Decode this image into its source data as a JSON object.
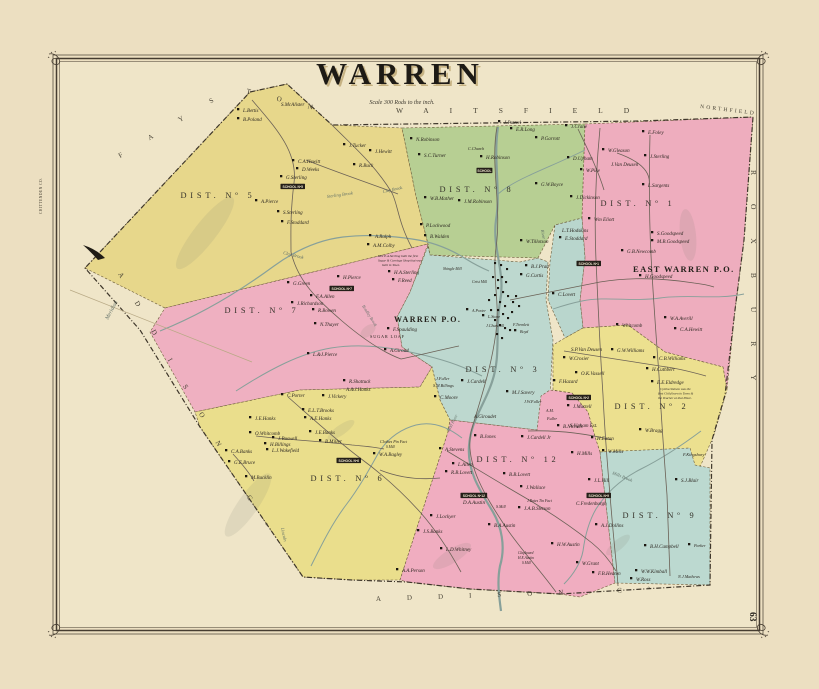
{
  "map": {
    "title": "WARREN",
    "scale_note": "Scale 300 Rods to the inch.",
    "page_number": "63",
    "post_offices": {
      "warren": "WARREN P.O.",
      "east_warren": "EAST WARREN P.O."
    },
    "neighbors": {
      "waitsfield": "WAITSFIELD",
      "northfield": "NORTHFIELD",
      "fayston_a": "FAYS",
      "fayston_b": "TON",
      "roxbury": "ROXBURY",
      "addison_side": "ADDISON Cº",
      "addison_bottom": "ADDISON Cº",
      "chittenden": "CHITTENDEN CO.",
      "meridian": "Meridian"
    },
    "colors": {
      "parchment": "#ecdfc1",
      "map_ground": "#efe5c8",
      "ink": "#2b2620",
      "water": "#87a09a",
      "road": "#6b6156",
      "frame": "#453c30",
      "dot": "#1b1711"
    },
    "districts": [
      {
        "id": "district-5",
        "label": "DIST. Nº 5",
        "color": "#e7d78b"
      },
      {
        "id": "district-7",
        "label": "DIST. Nº 7",
        "color": "#efb0c1"
      },
      {
        "id": "district-8",
        "label": "DIST. Nº 8",
        "color": "#b7cf93"
      },
      {
        "id": "district-1-east-warren",
        "label": "DIST. Nº 1",
        "color": "#eeadbe"
      },
      {
        "id": "district-3-east-sliver",
        "label": "",
        "color": "#b9d6cd"
      },
      {
        "id": "district-3",
        "label": "DIST. Nº 3",
        "color": "#bdd8cf"
      },
      {
        "id": "district-6",
        "label": "DIST. Nº 6",
        "color": "#eade8c"
      },
      {
        "id": "district-12",
        "label": "DIST. Nº 12",
        "color": "#f0adc0"
      },
      {
        "id": "district-2",
        "label": "DIST. Nº 2",
        "color": "#ece08f"
      },
      {
        "id": "district-9",
        "label": "DIST. Nº 9",
        "color": "#bcd9d0"
      }
    ],
    "labels": [
      {
        "t": "L.Bettis",
        "x": 243,
        "y": 112,
        "d": 1
      },
      {
        "t": "B.Poland",
        "x": 243,
        "y": 121,
        "d": 1
      },
      {
        "t": "S.McAlister",
        "x": 281,
        "y": 106
      },
      {
        "t": "J.Tucker",
        "x": 349,
        "y": 147,
        "d": 1
      },
      {
        "t": "C.A.Hewitt",
        "x": 298,
        "y": 163,
        "d": 1
      },
      {
        "t": "D.Weeks",
        "x": 302,
        "y": 171,
        "d": 1
      },
      {
        "t": "G.Sterling",
        "x": 286,
        "y": 179,
        "d": 1
      },
      {
        "t": "SCHOOL Nº5",
        "x": 282,
        "y": 188,
        "c": "school"
      },
      {
        "t": "A.Pierce",
        "x": 261,
        "y": 203,
        "d": 1
      },
      {
        "t": "S.Sterling",
        "x": 283,
        "y": 214,
        "d": 1
      },
      {
        "t": "F.Stoddard",
        "x": 287,
        "y": 224,
        "d": 1
      },
      {
        "t": "R.Buck",
        "x": 359,
        "y": 167,
        "d": 1
      },
      {
        "t": "J.Hewitt",
        "x": 375,
        "y": 153,
        "d": 1
      },
      {
        "t": "A.Ralph",
        "x": 375,
        "y": 238,
        "d": 1
      },
      {
        "t": "A.M.Colby",
        "x": 373,
        "y": 247,
        "d": 1
      },
      {
        "t": "Sterling Brook",
        "x": 327,
        "y": 198,
        "c": "water",
        "s": 4.5,
        "r": -8
      },
      {
        "t": "Clay Brook",
        "x": 283,
        "y": 254,
        "c": "water",
        "s": 4.6,
        "r": 14
      },
      {
        "t": "Clay Brook",
        "x": 383,
        "y": 193,
        "c": "water",
        "s": 4.4,
        "r": -12
      },
      {
        "t": "N.Robinson",
        "x": 416,
        "y": 141,
        "d": 1
      },
      {
        "t": "S.C.Turner",
        "x": 424,
        "y": 157,
        "d": 1
      },
      {
        "t": "C.Church",
        "x": 468,
        "y": 150,
        "s": 4.2
      },
      {
        "t": "H.Robinson",
        "x": 486,
        "y": 159,
        "d": 1
      },
      {
        "t": "SCHOOL",
        "x": 478,
        "y": 172,
        "c": "school"
      },
      {
        "t": "J.Puttrel",
        "x": 504,
        "y": 124,
        "d": 1
      },
      {
        "t": "E.R.Long",
        "x": 516,
        "y": 131,
        "d": 1
      },
      {
        "t": "P.Garrott",
        "x": 541,
        "y": 140,
        "d": 1
      },
      {
        "t": "W.B.Mather",
        "x": 430,
        "y": 200,
        "d": 1
      },
      {
        "t": "J.M.Robinson",
        "x": 464,
        "y": 203,
        "d": 1
      },
      {
        "t": "P.Lockwood",
        "x": 426,
        "y": 227,
        "d": 1
      },
      {
        "t": "B.Walden",
        "x": 430,
        "y": 238,
        "d": 1
      },
      {
        "t": "G.W.Boyce",
        "x": 541,
        "y": 186,
        "d": 1
      },
      {
        "t": "River",
        "x": 541,
        "y": 230,
        "c": "water",
        "s": 4.4,
        "r": 80
      },
      {
        "t": "J.Crane",
        "x": 571,
        "y": 128,
        "d": 1
      },
      {
        "t": "E.Foley",
        "x": 648,
        "y": 134,
        "d": 1
      },
      {
        "t": "W.Gleason",
        "x": 608,
        "y": 152,
        "d": 1
      },
      {
        "t": "D.Upham",
        "x": 573,
        "y": 160,
        "d": 1
      },
      {
        "t": "J.Sterling",
        "x": 650,
        "y": 158,
        "d": 1
      },
      {
        "t": "J.Van Deusen",
        "x": 611,
        "y": 166
      },
      {
        "t": "W.Pike",
        "x": 586,
        "y": 172,
        "d": 1
      },
      {
        "t": "L.Sargents",
        "x": 648,
        "y": 187,
        "d": 1
      },
      {
        "t": "J.Dickinson",
        "x": 576,
        "y": 199,
        "d": 1
      },
      {
        "t": "Wm Eliott",
        "x": 594,
        "y": 221,
        "d": 1
      },
      {
        "t": "W.Tillotson",
        "x": 526,
        "y": 243,
        "d": 1
      },
      {
        "t": "B.J.Pratt",
        "x": 531,
        "y": 268,
        "d": 1
      },
      {
        "t": "G.Curtis",
        "x": 526,
        "y": 277,
        "d": 1
      },
      {
        "t": "L.T.Hodskins",
        "x": 562,
        "y": 232
      },
      {
        "t": "E.Stoddard",
        "x": 565,
        "y": 240,
        "d": 1
      },
      {
        "t": "S.Goodspeed",
        "x": 657,
        "y": 235,
        "d": 1
      },
      {
        "t": "M.B.Goodspeed",
        "x": 657,
        "y": 243,
        "d": 1
      },
      {
        "t": "G.B.Newcomb",
        "x": 627,
        "y": 253,
        "d": 1
      },
      {
        "t": "SCHOOL Nº1",
        "x": 578,
        "y": 265,
        "c": "school"
      },
      {
        "t": "H.Goodspeed",
        "x": 645,
        "y": 278,
        "d": 1
      },
      {
        "t": "W.A.Averill",
        "x": 670,
        "y": 320,
        "d": 1
      },
      {
        "t": "C.A.Hewitt",
        "x": 680,
        "y": 331,
        "d": 1
      },
      {
        "t": "C.Lovett",
        "x": 558,
        "y": 296,
        "d": 1
      },
      {
        "t": "Whitcomb",
        "x": 622,
        "y": 327,
        "d": 1
      },
      {
        "t": "S.P.Van Deusen",
        "x": 571,
        "y": 351
      },
      {
        "t": "W.Crosier",
        "x": 569,
        "y": 360,
        "d": 1
      },
      {
        "t": "G.W.Williams",
        "x": 617,
        "y": 352,
        "d": 1
      },
      {
        "t": "C.B.Williams",
        "x": 659,
        "y": 360,
        "d": 1
      },
      {
        "t": "H.Cuthbert",
        "x": 652,
        "y": 371,
        "d": 1
      },
      {
        "t": "O.K.Vassell",
        "x": 581,
        "y": 375,
        "d": 1
      },
      {
        "t": "F.Hazard",
        "x": 559,
        "y": 383,
        "d": 1
      },
      {
        "t": "E.E.Eldredge",
        "x": 657,
        "y": 384,
        "d": 1
      },
      {
        "t": "Cyntha Stetson was the",
        "x": 660,
        "y": 390,
        "c": "note"
      },
      {
        "t": "first Child born in Town &",
        "x": 658,
        "y": 394.5,
        "c": "note"
      },
      {
        "t": "the Teacher at that Place.",
        "x": 658,
        "y": 399,
        "c": "note"
      },
      {
        "t": "SCHOOL Nº2",
        "x": 568,
        "y": 399,
        "c": "school"
      },
      {
        "t": "J.Martell",
        "x": 573,
        "y": 408,
        "d": 1
      },
      {
        "t": "S.Upham Est.",
        "x": 570,
        "y": 427
      },
      {
        "t": "H.Eaton",
        "x": 597,
        "y": 440,
        "d": 1
      },
      {
        "t": "W.Bragg",
        "x": 645,
        "y": 432,
        "d": 1
      },
      {
        "t": "F.Kingsbury",
        "x": 683,
        "y": 456,
        "s": 4.4
      },
      {
        "t": "H.Mills",
        "x": 577,
        "y": 455,
        "d": 1
      },
      {
        "t": "W.Mills",
        "x": 608,
        "y": 453,
        "d": 1
      },
      {
        "t": "Mills Brook",
        "x": 612,
        "y": 474,
        "c": "water",
        "s": 4.5,
        "r": 22
      },
      {
        "t": "J.L.Hill",
        "x": 594,
        "y": 482,
        "d": 1
      },
      {
        "t": "SCHOOL Nº9",
        "x": 588,
        "y": 497,
        "c": "school"
      },
      {
        "t": "C.Fredenburgh",
        "x": 576,
        "y": 505
      },
      {
        "t": "S.J.Blair",
        "x": 681,
        "y": 482,
        "d": 1
      },
      {
        "t": "A.J.Dollins",
        "x": 601,
        "y": 527,
        "d": 1
      },
      {
        "t": "B.H.Campbell",
        "x": 650,
        "y": 548,
        "d": 1
      },
      {
        "t": "Parker",
        "x": 694,
        "y": 547,
        "s": 4.2,
        "d": 1
      },
      {
        "t": "N.J.Mathews",
        "x": 678,
        "y": 578,
        "s": 4.2
      },
      {
        "t": "W.W.Kimball",
        "x": 641,
        "y": 573,
        "d": 1
      },
      {
        "t": "W.Ross",
        "x": 636,
        "y": 581,
        "d": 1
      },
      {
        "t": "W.Grant",
        "x": 582,
        "y": 565,
        "d": 1
      },
      {
        "t": "F.B.Heaton",
        "x": 598,
        "y": 575,
        "d": 1
      },
      {
        "t": "B.Jones",
        "x": 480,
        "y": 438,
        "d": 1
      },
      {
        "t": "J.Cardell Jr",
        "x": 527,
        "y": 439,
        "d": 1
      },
      {
        "t": "A.Stevens",
        "x": 445,
        "y": 451,
        "d": 1
      },
      {
        "t": "L.Allen",
        "x": 458,
        "y": 466,
        "d": 1
      },
      {
        "t": "R.B.Lovett",
        "x": 451,
        "y": 474,
        "d": 1
      },
      {
        "t": "B.B.Lovett",
        "x": 509,
        "y": 476,
        "d": 1
      },
      {
        "t": "J.Wallace",
        "x": 526,
        "y": 489,
        "d": 1
      },
      {
        "t": "SCHOOL Nº12",
        "x": 462,
        "y": 497,
        "c": "school"
      },
      {
        "t": "D.A.Austin",
        "x": 463,
        "y": 504
      },
      {
        "t": "S.Mill",
        "x": 496,
        "y": 508,
        "s": 4
      },
      {
        "t": "J.Bates Tin Fact",
        "x": 527,
        "y": 502,
        "s": 3.8
      },
      {
        "t": "J.A.B.Stetson",
        "x": 524,
        "y": 510,
        "d": 1
      },
      {
        "t": "J.Lockyer",
        "x": 436,
        "y": 518,
        "d": 1
      },
      {
        "t": "J.S.Banks",
        "x": 423,
        "y": 533,
        "d": 1
      },
      {
        "t": "B.A.Austin",
        "x": 494,
        "y": 527,
        "d": 1
      },
      {
        "t": "H.W.Austin",
        "x": 557,
        "y": 546,
        "d": 1
      },
      {
        "t": "L.D.Whitney",
        "x": 446,
        "y": 551,
        "d": 1
      },
      {
        "t": "A.A.Person",
        "x": 402,
        "y": 572,
        "d": 1
      },
      {
        "t": "Clapboard",
        "x": 518,
        "y": 554,
        "s": 3.6
      },
      {
        "t": "H.E.Austin",
        "x": 518,
        "y": 559,
        "s": 3.6
      },
      {
        "t": "S.Mill",
        "x": 522,
        "y": 564,
        "s": 3.6
      },
      {
        "t": "C.Porter",
        "x": 287,
        "y": 397,
        "d": 1
      },
      {
        "t": "E.L.T.Brooks",
        "x": 308,
        "y": 412,
        "d": 1
      },
      {
        "t": "A.E.Hanks",
        "x": 310,
        "y": 420,
        "d": 1
      },
      {
        "t": "J.E.Hanks",
        "x": 255,
        "y": 420,
        "d": 1
      },
      {
        "t": "O.Whitcomb",
        "x": 255,
        "y": 435,
        "d": 1
      },
      {
        "t": "J.Buswell",
        "x": 278,
        "y": 440,
        "d": 1
      },
      {
        "t": "H.Billings",
        "x": 270,
        "y": 446,
        "d": 1
      },
      {
        "t": "L.J.Wakefield",
        "x": 272,
        "y": 452,
        "d": 1
      },
      {
        "t": "J.E.Banks",
        "x": 315,
        "y": 434,
        "d": 1
      },
      {
        "t": "B.Miller",
        "x": 325,
        "y": 443,
        "d": 1
      },
      {
        "t": "C.A.Banks",
        "x": 231,
        "y": 453,
        "d": 1
      },
      {
        "t": "G.E.Bruce",
        "x": 234,
        "y": 464,
        "d": 1
      },
      {
        "t": "M.Bucklin",
        "x": 251,
        "y": 479,
        "d": 1
      },
      {
        "t": "Clothes Pin Fact",
        "x": 380,
        "y": 443,
        "s": 4
      },
      {
        "t": "S.Mill",
        "x": 386,
        "y": 448,
        "s": 3.6
      },
      {
        "t": "W.A.Bagley",
        "x": 379,
        "y": 456,
        "d": 1
      },
      {
        "t": "SCHOOL Nº6",
        "x": 338,
        "y": 462,
        "c": "school"
      },
      {
        "t": "Lincoln",
        "x": 281,
        "y": 528,
        "c": "water",
        "s": 4.6,
        "r": 78
      },
      {
        "t": "G.Green",
        "x": 293,
        "y": 285,
        "d": 1
      },
      {
        "t": "H.Pierce",
        "x": 343,
        "y": 279,
        "d": 1
      },
      {
        "t": "SCHOOL Nº7",
        "x": 331,
        "y": 290,
        "c": "school"
      },
      {
        "t": "F.A.Allen",
        "x": 316,
        "y": 298,
        "d": 1
      },
      {
        "t": "J.Richardson",
        "x": 297,
        "y": 305,
        "d": 1
      },
      {
        "t": "R.Bowen",
        "x": 318,
        "y": 312,
        "d": 1
      },
      {
        "t": "N.Thayer",
        "x": 320,
        "y": 326,
        "d": 1
      },
      {
        "t": "L.&J.Pierce",
        "x": 313,
        "y": 356,
        "d": 1
      },
      {
        "t": "Bradley Brook",
        "x": 362,
        "y": 306,
        "c": "water",
        "s": 4.2,
        "r": 58
      },
      {
        "t": "SUGAR LOAF",
        "x": 370,
        "y": 338,
        "s": 4.3,
        "c": "capsname"
      },
      {
        "t": "R.Shattuck",
        "x": 349,
        "y": 383,
        "d": 1
      },
      {
        "t": "A.&J.Hanks",
        "x": 346,
        "y": 391
      },
      {
        "t": "J.Vickery",
        "x": 328,
        "y": 398,
        "d": 1
      },
      {
        "t": "Mrs E.A.Sterling built the first",
        "x": 378,
        "y": 257,
        "c": "note"
      },
      {
        "t": "Sugar & Carriage Shop that was",
        "x": 378,
        "y": 261.5,
        "c": "note"
      },
      {
        "t": "built in Town.",
        "x": 382,
        "y": 266,
        "c": "note"
      },
      {
        "t": "H.A.Sterling",
        "x": 394,
        "y": 274,
        "d": 1
      },
      {
        "t": "F.Reed",
        "x": 398,
        "y": 282,
        "d": 1
      },
      {
        "t": "Shingle Mill",
        "x": 443,
        "y": 270,
        "s": 3.8
      },
      {
        "t": "Grist Mill",
        "x": 472,
        "y": 283,
        "s": 3.8
      },
      {
        "t": "A.Porter",
        "x": 472,
        "y": 312,
        "s": 4,
        "d": 1
      },
      {
        "t": "L.Stone",
        "x": 488,
        "y": 318,
        "s": 4,
        "d": 1
      },
      {
        "t": "J.Churchill",
        "x": 486,
        "y": 327,
        "s": 4
      },
      {
        "t": "F.Tremlett",
        "x": 513,
        "y": 326,
        "s": 4
      },
      {
        "t": "Boyd",
        "x": 520,
        "y": 333,
        "s": 4,
        "d": 1
      },
      {
        "t": "F.Spaulding",
        "x": 393,
        "y": 331,
        "d": 1
      },
      {
        "t": "A.Giroud",
        "x": 390,
        "y": 352,
        "d": 1
      },
      {
        "t": "J.Fuller",
        "x": 436,
        "y": 380,
        "s": 4.2
      },
      {
        "t": "S.M.Billings",
        "x": 433,
        "y": 387,
        "s": 4.2
      },
      {
        "t": "C.Moore",
        "x": 440,
        "y": 399,
        "d": 1
      },
      {
        "t": "A.Giroudet",
        "x": 474,
        "y": 418
      },
      {
        "t": "J.Cardell",
        "x": 467,
        "y": 383,
        "d": 1
      },
      {
        "t": "M.J.Savery",
        "x": 512,
        "y": 394,
        "d": 1
      },
      {
        "t": "J.W.Fuller",
        "x": 524,
        "y": 403,
        "s": 4.2
      },
      {
        "t": "A.M.",
        "x": 546,
        "y": 412,
        "s": 4
      },
      {
        "t": "Fuller",
        "x": 547,
        "y": 420,
        "s": 4
      },
      {
        "t": "B.Nichols",
        "x": 563,
        "y": 428,
        "d": 1
      },
      {
        "t": "Mad River",
        "x": 449,
        "y": 432,
        "c": "water",
        "s": 4.4,
        "r": -62
      }
    ],
    "village_dots": [
      [
        492,
        276
      ],
      [
        497,
        279
      ],
      [
        501,
        276
      ],
      [
        505,
        281
      ],
      [
        497,
        287
      ],
      [
        502,
        291
      ],
      [
        507,
        295
      ],
      [
        494,
        294
      ],
      [
        499,
        301
      ],
      [
        504,
        305
      ],
      [
        497,
        309
      ],
      [
        502,
        313
      ],
      [
        507,
        317
      ],
      [
        511,
        311
      ],
      [
        494,
        319
      ],
      [
        499,
        324
      ],
      [
        504,
        327
      ],
      [
        509,
        329
      ],
      [
        496,
        333
      ],
      [
        501,
        337
      ],
      [
        512,
        301
      ],
      [
        515,
        295
      ],
      [
        518,
        305
      ],
      [
        488,
        299
      ],
      [
        490,
        309
      ],
      [
        506,
        268
      ],
      [
        500,
        264
      ],
      [
        494,
        262
      ]
    ]
  }
}
